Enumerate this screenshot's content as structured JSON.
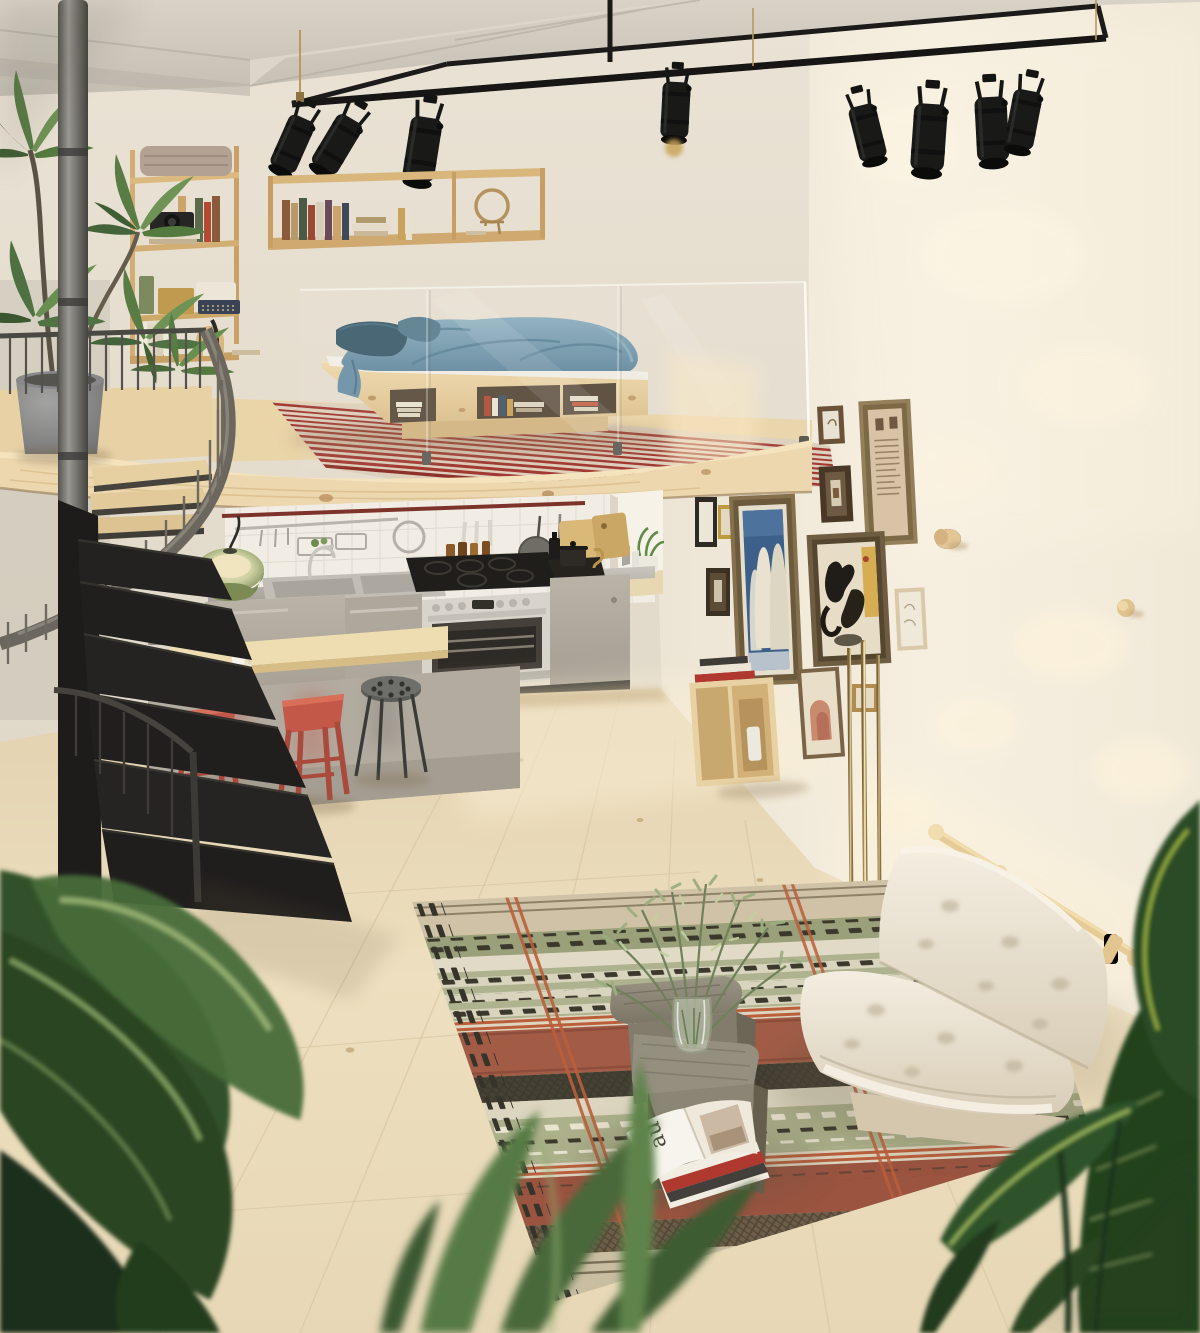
{
  "meta": {
    "title": "Sunlit loft studio apartment",
    "description": "Photorealistic render of a small loft apartment: mezzanine platform bed with blue bedding behind glass balustrade, black spiral staircase, stainless steel kitchen with gas range, breakfast bar with red stools, gallery wall of framed art, white futon sofa on a patterned kilim rug, side tables with olive branches in a glass vase, and leafy foreground plants."
  },
  "magazine": {
    "cover_text": "au"
  },
  "objects": {
    "lighting": [
      "black track light frame",
      "eight black PAR spotlights",
      "green glass pendant lamp",
      "brass floor lamp rods"
    ],
    "mezzanine": [
      "pine platform bed",
      "blue duvet and pillows",
      "storage cubbies with books",
      "red striped rug",
      "glass balustrade",
      "pine edge beam"
    ],
    "kitchen": [
      "stainless counter and sink",
      "gas range cooker with oven",
      "white tile backsplash",
      "utensil rail",
      "window niche with plant",
      "cutting boards",
      "spice tray"
    ],
    "dining": [
      "wooden breakfast bar",
      "french press",
      "espresso cups",
      "two red wooden stools",
      "grey metal stool"
    ],
    "living": [
      "white tufted futon",
      "pine wall rail",
      "patterned kilim rug",
      "two grey wood side tables",
      "glass vase with olive branches",
      "open magazine",
      "magazine stack",
      "paper lantern ball"
    ],
    "walls": [
      "long pine wall shelf with books",
      "three-tier pine shelf with camera and typewriter",
      "gallery of picture frames",
      "blue figures artwork",
      "dancing figures artwork",
      "wooden wall hooks",
      "pine cube shelf with books"
    ],
    "plants": [
      "tall dracaena in grey pot",
      "foreground banana leaves",
      "bird of paradise leaves"
    ],
    "structure": [
      "black spiral staircase",
      "pale wood plank floor",
      "concrete ceiling beams"
    ]
  },
  "palette": {
    "wall": "#e9e2d4",
    "wall_sunlit": "#f6efe0",
    "ceiling": "#d0cabf",
    "pine_wood": "#e8d2a6",
    "floor": "#ecdcbd",
    "metal_black": "#1b1a18",
    "stair_grey": "#6b665e",
    "duvet_blue": "#7fa1b3",
    "pillow_teal": "#46677a",
    "rug_stripe_red": "#a23a33",
    "stool_red": "#c1574a",
    "cabinet_greige": "#b2aba0",
    "pendant_green": "#82925c",
    "futon_cream": "#efe8d9",
    "rug_sage": "#acb08b",
    "rug_terracotta": "#bb5f3b",
    "rug_brown": "#6e5d48",
    "art_blue": "#3c608a",
    "plant_green": "#3f6134",
    "brass": "#c3a868"
  }
}
